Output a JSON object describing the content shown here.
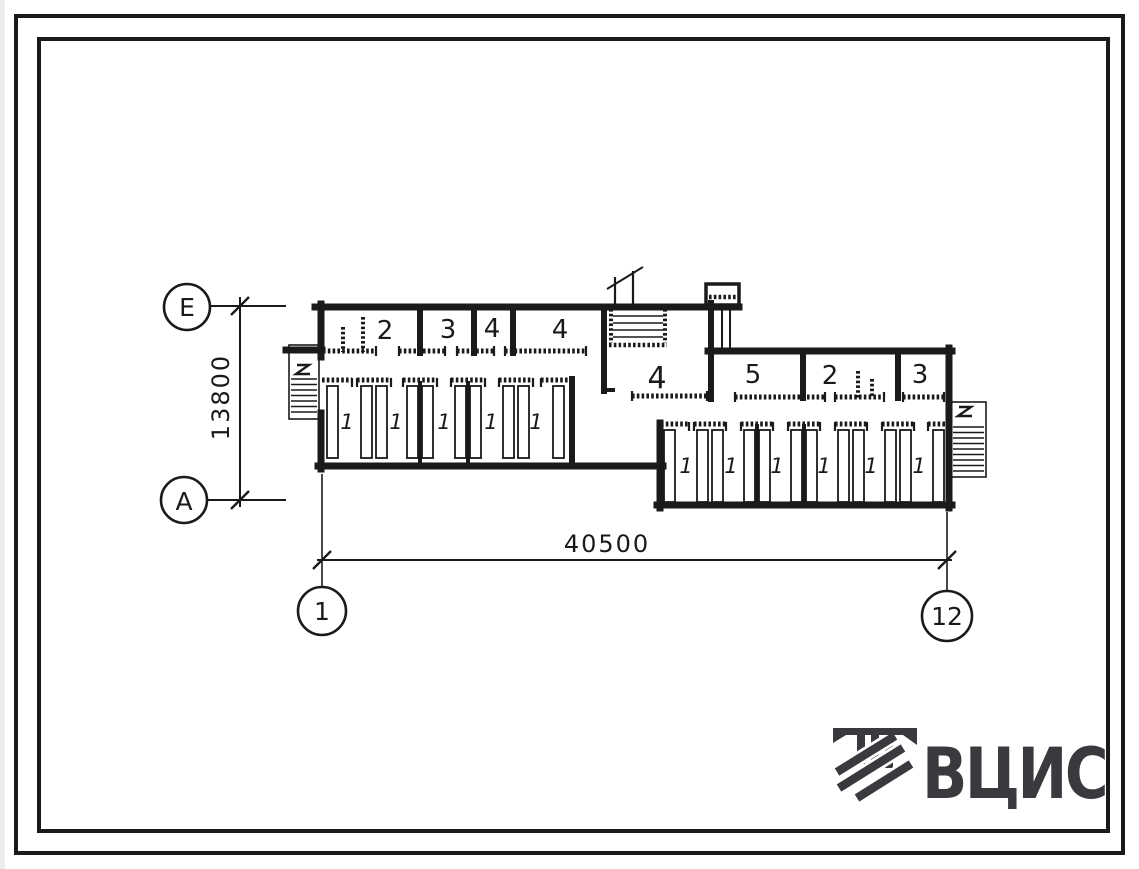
{
  "page": {
    "background": "#ffffff",
    "ink_color": "#1a1a1a",
    "logo_color": "#3a3a3e"
  },
  "axes": {
    "row_top": "Е",
    "row_bottom": "А",
    "col_left": "1",
    "col_right": "12"
  },
  "dims": {
    "vertical": "13800",
    "horizontal": "40500"
  },
  "rooms": {
    "top_left": [
      "2",
      "3",
      "4",
      "4"
    ],
    "center": "4",
    "top_right": [
      "5",
      "2",
      "3"
    ]
  },
  "stalls": {
    "left": [
      "1",
      "1",
      "1",
      "1",
      "1"
    ],
    "right": [
      "1",
      "1",
      "1",
      "1",
      "1",
      "1"
    ]
  },
  "logo": {
    "text": "ВЦИС"
  }
}
